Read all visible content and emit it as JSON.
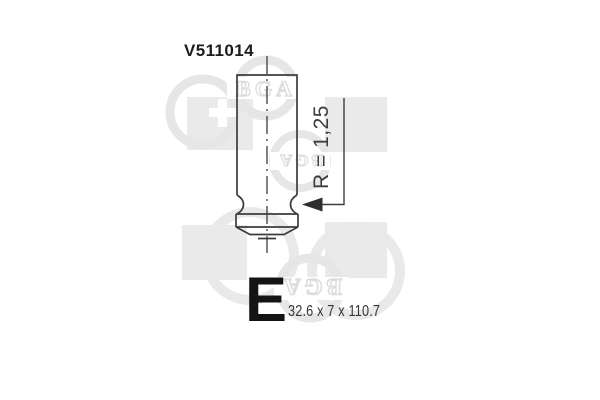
{
  "part": {
    "number": "V511014",
    "radius_label": "R = 1,25",
    "type_letter": "E",
    "dimensions": "32.6 x 7 x 110.7"
  },
  "watermark": {
    "brand": "BGA",
    "square_color": "#eaeaea",
    "ring_color": "#e6e6e6"
  },
  "drawing": {
    "subject": "engine-valve-outline",
    "line_color": "#3c3c3c",
    "arrow_color": "#2e2e2e"
  }
}
